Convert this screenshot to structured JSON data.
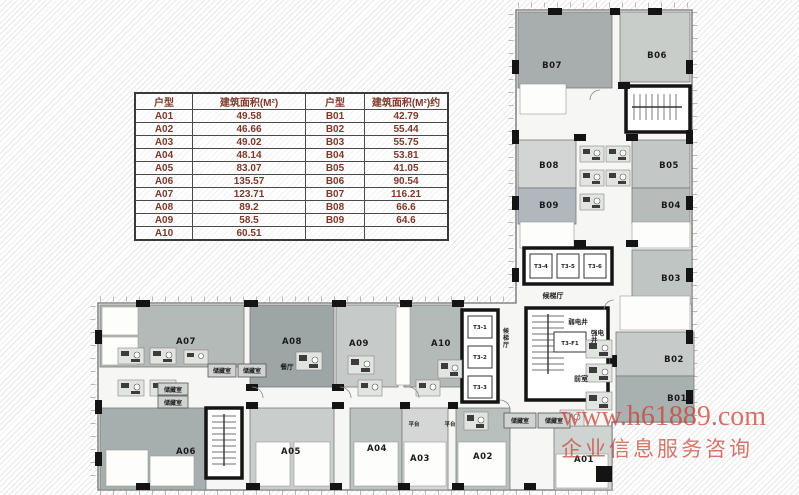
{
  "palette": {
    "hatch_line": "#e8e8e8",
    "wall": "#141414",
    "plan_bg": "#f6f6f4",
    "table_text": "#7c3a2a",
    "table_border": "#3a3a3a",
    "watermark_red": "#c63e32",
    "units": {
      "b07": "#a7aead",
      "b06": "#c9cdca",
      "b08": "#d2d5d3",
      "b05": "#c3c8c6",
      "b09": "#b0b7bd",
      "b04": "#b7bcba",
      "b03": "#bfc5c3",
      "b02": "#c6cbc9",
      "b01": "#a9b1b0",
      "a07": "#b3bab8",
      "a08": "#9da6a5",
      "a09": "#c6cbc9",
      "a10": "#b3bab8",
      "a06": "#a7afae",
      "a05": "#c9cdcb",
      "a04": "#bcc2c0",
      "a03": "#d4d7d5",
      "a02": "#b8bfbd",
      "a01": "#cfd3d1"
    }
  },
  "table": {
    "headers": [
      "户型",
      "建筑面积(M²)",
      "户型",
      "建筑面积(M²)约"
    ],
    "rows": [
      [
        "A01",
        "49.58",
        "B01",
        "42.79"
      ],
      [
        "A02",
        "46.66",
        "B02",
        "55.44"
      ],
      [
        "A03",
        "49.02",
        "B03",
        "55.75"
      ],
      [
        "A04",
        "48.14",
        "B04",
        "53.81"
      ],
      [
        "A05",
        "83.07",
        "B05",
        "41.05"
      ],
      [
        "A06",
        "135.57",
        "B06",
        "90.54"
      ],
      [
        "A07",
        "123.71",
        "B07",
        "116.21"
      ],
      [
        "A08",
        "89.2",
        "B08",
        "66.6"
      ],
      [
        "A09",
        "58.5",
        "B09",
        "64.6"
      ],
      [
        "A10",
        "60.51",
        "",
        ""
      ]
    ]
  },
  "plan": {
    "units": {
      "a01": "A01",
      "a02": "A02",
      "a03": "A03",
      "a04": "A04",
      "a05": "A05",
      "a06": "A06",
      "a07": "A07",
      "a08": "A08",
      "a09": "A09",
      "a10": "A10",
      "b01": "B01",
      "b02": "B02",
      "b03": "B03",
      "b04": "B04",
      "b05": "B05",
      "b06": "B06",
      "b07": "B07",
      "b08": "B08",
      "b09": "B09"
    },
    "elevators": {
      "t3_1": "T3-1",
      "t3_2": "T3-2",
      "t3_3": "T3-3",
      "t3_4": "T3-4",
      "t3_5": "T3-5",
      "t3_6": "T3-6",
      "t3_f1": "T3-F1"
    },
    "rooms": {
      "lobby": "候梯厅",
      "weak_shaft": "弱电井",
      "strong_shaft": "强电井",
      "front_room": "前室",
      "storage": "储藏室",
      "dining": "餐厅",
      "platform": "平台"
    }
  },
  "watermark": {
    "line1": "www.h61889.com",
    "line2": "企业信息服务咨询"
  }
}
